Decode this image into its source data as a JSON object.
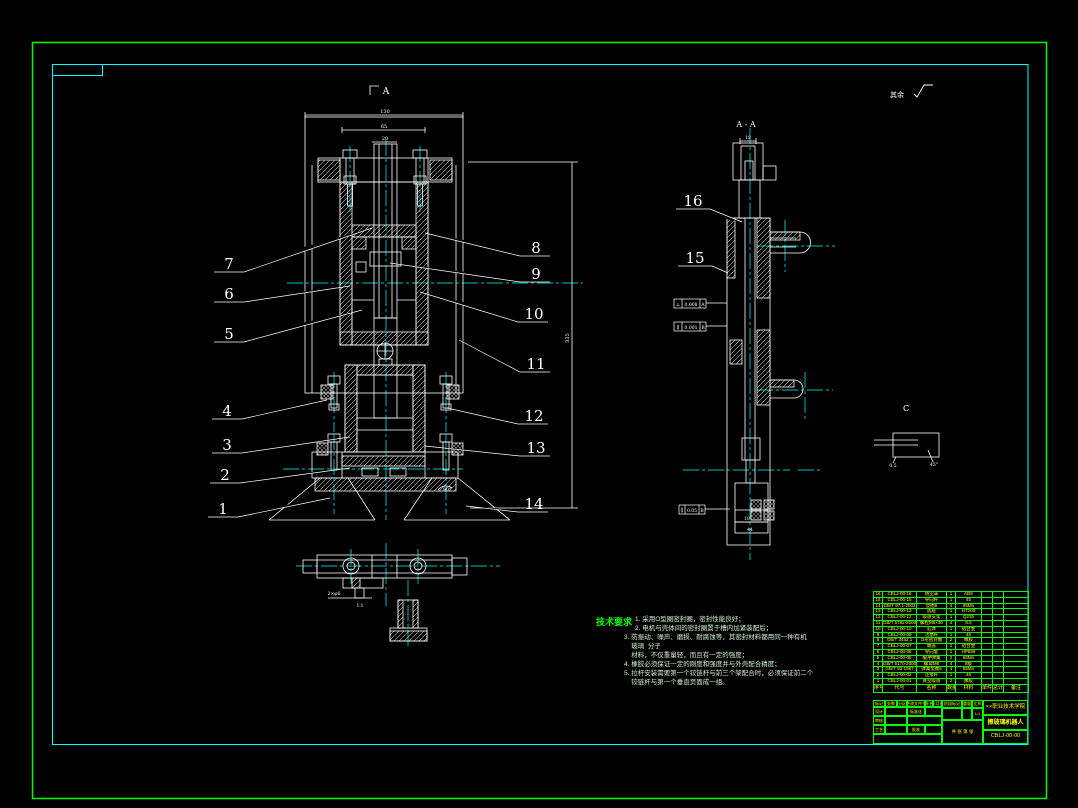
{
  "colors": {
    "border_green": "#00ff00",
    "frame_cyan": "#00ffff",
    "line_white": "#ffffff",
    "table_text_yellow": "#ffff00",
    "notes_green": "#00ff00"
  },
  "drawing": {
    "surface_note": "其余",
    "front_section_mark": "A",
    "side_section_label": "A - A",
    "detail_label": "C",
    "angle_label": "90°",
    "scale_label": "1∶1",
    "foot_dim": "2×φ6",
    "dims": {
      "top_outer": "130",
      "top_mid": "65",
      "top_inner": "20",
      "height": "335",
      "side_top": "18",
      "side_b1": "18",
      "side_b2": "44",
      "detail_a": "0.5",
      "detail_b": "45°"
    },
    "callouts": {
      "left": [
        "7",
        "6",
        "5",
        "4",
        "3",
        "2",
        "1"
      ],
      "right": [
        "8",
        "9",
        "10",
        "11",
        "12",
        "13",
        "14"
      ],
      "side": [
        "16",
        "15"
      ]
    },
    "tolerances": [
      {
        "sym": "⊥",
        "val": "0.008",
        "ref": "A"
      },
      {
        "sym": "∥",
        "val": "0.001",
        "ref": "B"
      },
      {
        "sym": "∥",
        "val": "0.05",
        "ref": "B"
      }
    ]
  },
  "notes": {
    "title": "技术要求",
    "lines": [
      "1. 采用O型圈密封圈，密封性能良好；",
      "2. 电机与壳体间的密封圈置于槽内加紧装配后；",
      "3. 防振动、噪声、磨损、耐腐蚀等，其密封材料都用同一种有机",
      "    玻璃  分子",
      "    材料，不仅重量轻，而且有一定的强度；",
      "4. 橡胶必须保证一定的刚度和强度并与外壳配合精度；",
      "5. 拉杆安装需要第一个铰链杆与前三个架配合时，必须保证前二个",
      "    铰链杆与第一个垂直页面成一组。"
    ]
  },
  "parts_table": {
    "headers": [
      "序号",
      "代号",
      "名称",
      "数量",
      "材料",
      "单件",
      "总计",
      "备注"
    ],
    "rows": [
      [
        "16",
        "CBLJ-00-16",
        "防尘罩",
        "1",
        "ABS",
        "",
        "",
        ""
      ],
      [
        "15",
        "CBLJ-00-15",
        "导向杆",
        "1",
        "45",
        "",
        "",
        ""
      ],
      [
        "14",
        "GB/T 97.1-2002",
        "垫圈6",
        "4",
        "65Mn",
        "",
        "",
        ""
      ],
      [
        "13",
        "CBLJ-00-13",
        "底座",
        "1",
        "HT200",
        "",
        "",
        ""
      ],
      [
        "12",
        "CBLJ-00-12",
        "吸盘支架",
        "1",
        "Q235",
        "",
        "",
        ""
      ],
      [
        "11",
        "GB/T 5782-2000",
        "螺栓M6×30",
        "4",
        "8.8",
        "",
        "",
        ""
      ],
      [
        "10",
        "CBLJ-00-10",
        "缸体",
        "1",
        "铝合金",
        "",
        "",
        ""
      ],
      [
        "9",
        "CBLJ-00-09",
        "活塞杆",
        "1",
        "45",
        "",
        "",
        ""
      ],
      [
        "8",
        "GB/T 3452.1",
        "O形密封圈",
        "2",
        "橡胶",
        "",
        "",
        ""
      ],
      [
        "7",
        "CBLJ-00-07",
        "端盖",
        "1",
        "铝合金",
        "",
        "",
        ""
      ],
      [
        "6",
        "CBLJ-00-06",
        "导向套",
        "1",
        "HPb59",
        "",
        "",
        ""
      ],
      [
        "5",
        "CBLJ-00-05",
        "缓冲弹簧",
        "2",
        "65Mn",
        "",
        "",
        ""
      ],
      [
        "4",
        "GB/T 6170-2000",
        "螺母M6",
        "4",
        "8级",
        "",
        "",
        ""
      ],
      [
        "3",
        "GB/T 93-1987",
        "弹簧垫圈6",
        "4",
        "65Mn",
        "",
        "",
        ""
      ],
      [
        "2",
        "CBLJ-00-02",
        "连接杆",
        "1",
        "45",
        "",
        "",
        ""
      ],
      [
        "1",
        "CBLJ-00-01",
        "真空吸盘",
        "2",
        "橡胶",
        "",
        "",
        ""
      ]
    ]
  },
  "title_block": {
    "school": "××职业技术学院",
    "title": "擦玻璃机器人",
    "drawing_no": "CBLJ-00-00",
    "fields": {
      "mark": "标记",
      "count": "处数",
      "zone": "分区",
      "change_no": "更改文件号",
      "sign": "签名",
      "date": "年月日",
      "design": "设计",
      "standard": "标准化",
      "check": "审核",
      "process": "工艺",
      "approve": "批准",
      "stage": "阶段标记",
      "weight": "重量",
      "scale": "比例",
      "scale_value": "1:1",
      "sheets": "共 张 第 张"
    }
  }
}
